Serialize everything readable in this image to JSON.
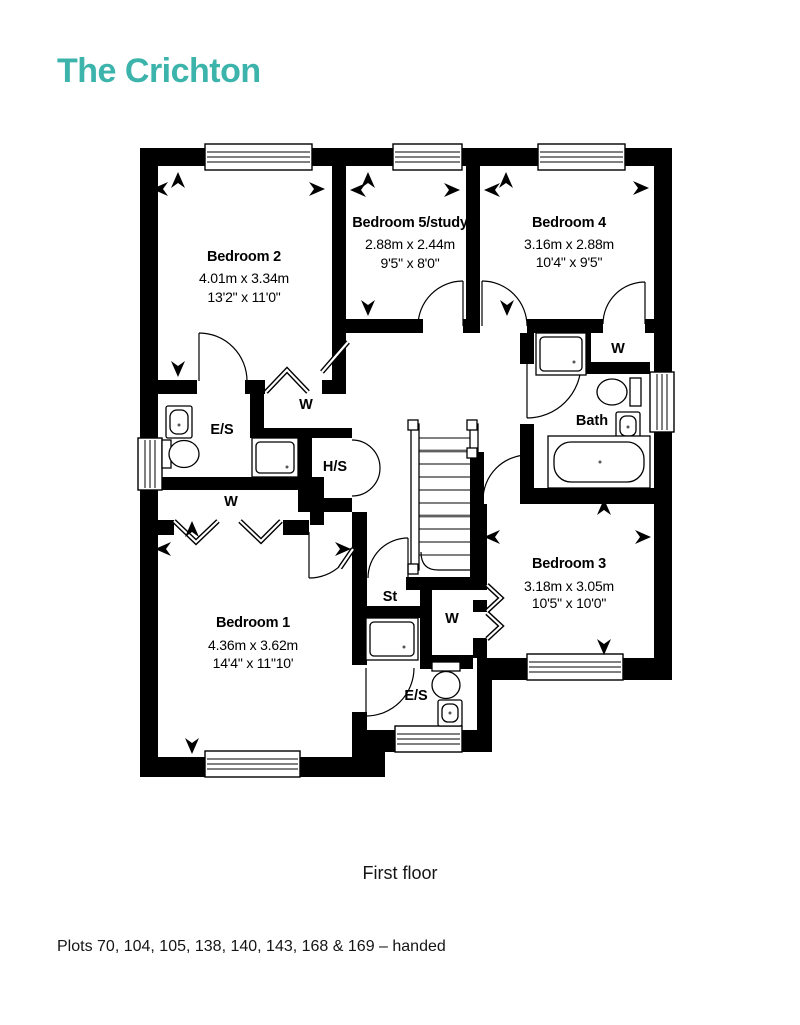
{
  "title": "The Crichton",
  "accent_color": "#3CB4AB",
  "caption": "First floor",
  "footnote": "Plots 70, 104, 105, 138, 140, 143, 168 & 169 – handed",
  "rooms": {
    "bedroom2": {
      "name": "Bedroom 2",
      "metric": "4.01m x 3.34m",
      "imperial": "13'2\" x 11'0\""
    },
    "bedroom5": {
      "name": "Bedroom 5/study",
      "metric": "2.88m x 2.44m",
      "imperial": "9'5\" x 8'0\""
    },
    "bedroom4": {
      "name": "Bedroom 4",
      "metric": "3.16m x 2.88m",
      "imperial": "10'4\" x 9'5\""
    },
    "bedroom1": {
      "name": "Bedroom 1",
      "metric": "4.36m x 3.62m",
      "imperial": "14'4\" x 11\"10'"
    },
    "bedroom3": {
      "name": "Bedroom 3",
      "metric": "3.18m x 3.05m",
      "imperial": "10'5\" x 10'0\""
    },
    "bath": {
      "name": "Bath"
    }
  },
  "labels": {
    "ensuite": "E/S",
    "wardrobe": "W",
    "hot_water": "H/S",
    "store": "St"
  }
}
